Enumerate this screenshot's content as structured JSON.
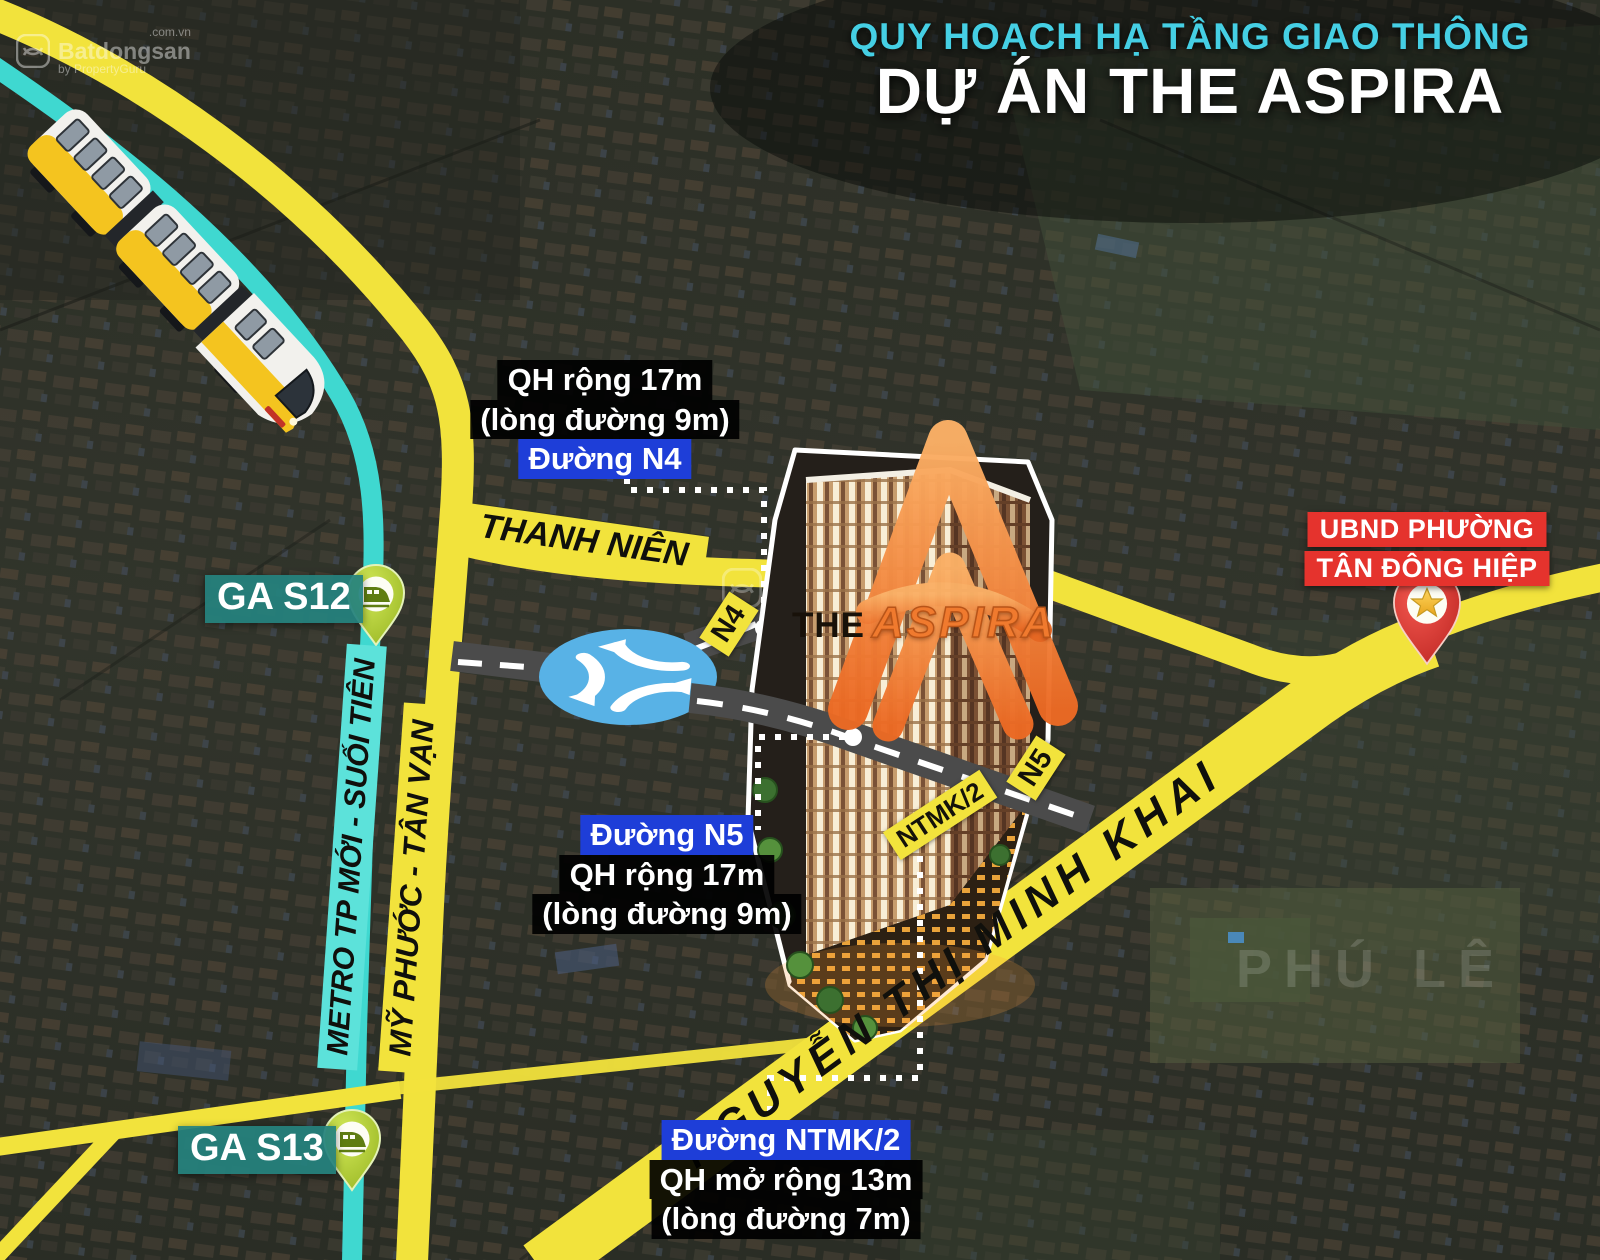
{
  "title": {
    "line1": "QUY HOẠCH HẠ TẦNG GIAO THÔNG",
    "line2": "DỰ ÁN THE ASPIRA"
  },
  "metro": {
    "line_label": "METRO TP MỚI - SUỐI TIÊN",
    "stations": [
      {
        "name": "GA S12"
      },
      {
        "name": "GA S13"
      }
    ]
  },
  "roads": {
    "my_phuoc_tan_van": "MỸ PHƯỚC - TÂN VẠN",
    "thanh_nien": "THANH NIÊN",
    "nguyen_thi_minh_khai": "NGUYỄN THỊ MINH KHAI",
    "tags": {
      "n4": "N4",
      "n5": "N5",
      "ntmk2": "NTMK/2"
    }
  },
  "callouts": {
    "n4": {
      "line1": "QH rộng 17m",
      "line2": "(lòng đường 9m)",
      "road": "Đường N4"
    },
    "n5": {
      "road": "Đường N5",
      "line1": "QH rộng 17m",
      "line2": "(lòng đường 9m)"
    },
    "ntmk2": {
      "road": "Đường NTMK/2",
      "line1": "QH mở rộng 13m",
      "line2": "(lòng đường 7m)"
    }
  },
  "poi": {
    "ubnd_line1": "UBND PHƯỜNG",
    "ubnd_line2": "TÂN ĐÔNG HIỆP"
  },
  "project": {
    "word_the": "THE",
    "word_name": "ASPIRA"
  },
  "watermarks": {
    "brand": "Batdongsan",
    "tld": ".com.vn",
    "byline": "by PropertyGuru",
    "corner": "PHÚ LÊ"
  },
  "colors": {
    "road_yellow": "#f2e33c",
    "metro_cyan": "#3fd8d0",
    "teal": "#25827e",
    "pin_green": "#a9cb28",
    "label_blue": "#1e3ed8",
    "label_red": "#e5332d",
    "title_cyan": "#45cfe4",
    "logo_orange": "#f07a2e",
    "roundabout_blue": "#58b2e6",
    "dark_road": "#4b4b4b"
  }
}
